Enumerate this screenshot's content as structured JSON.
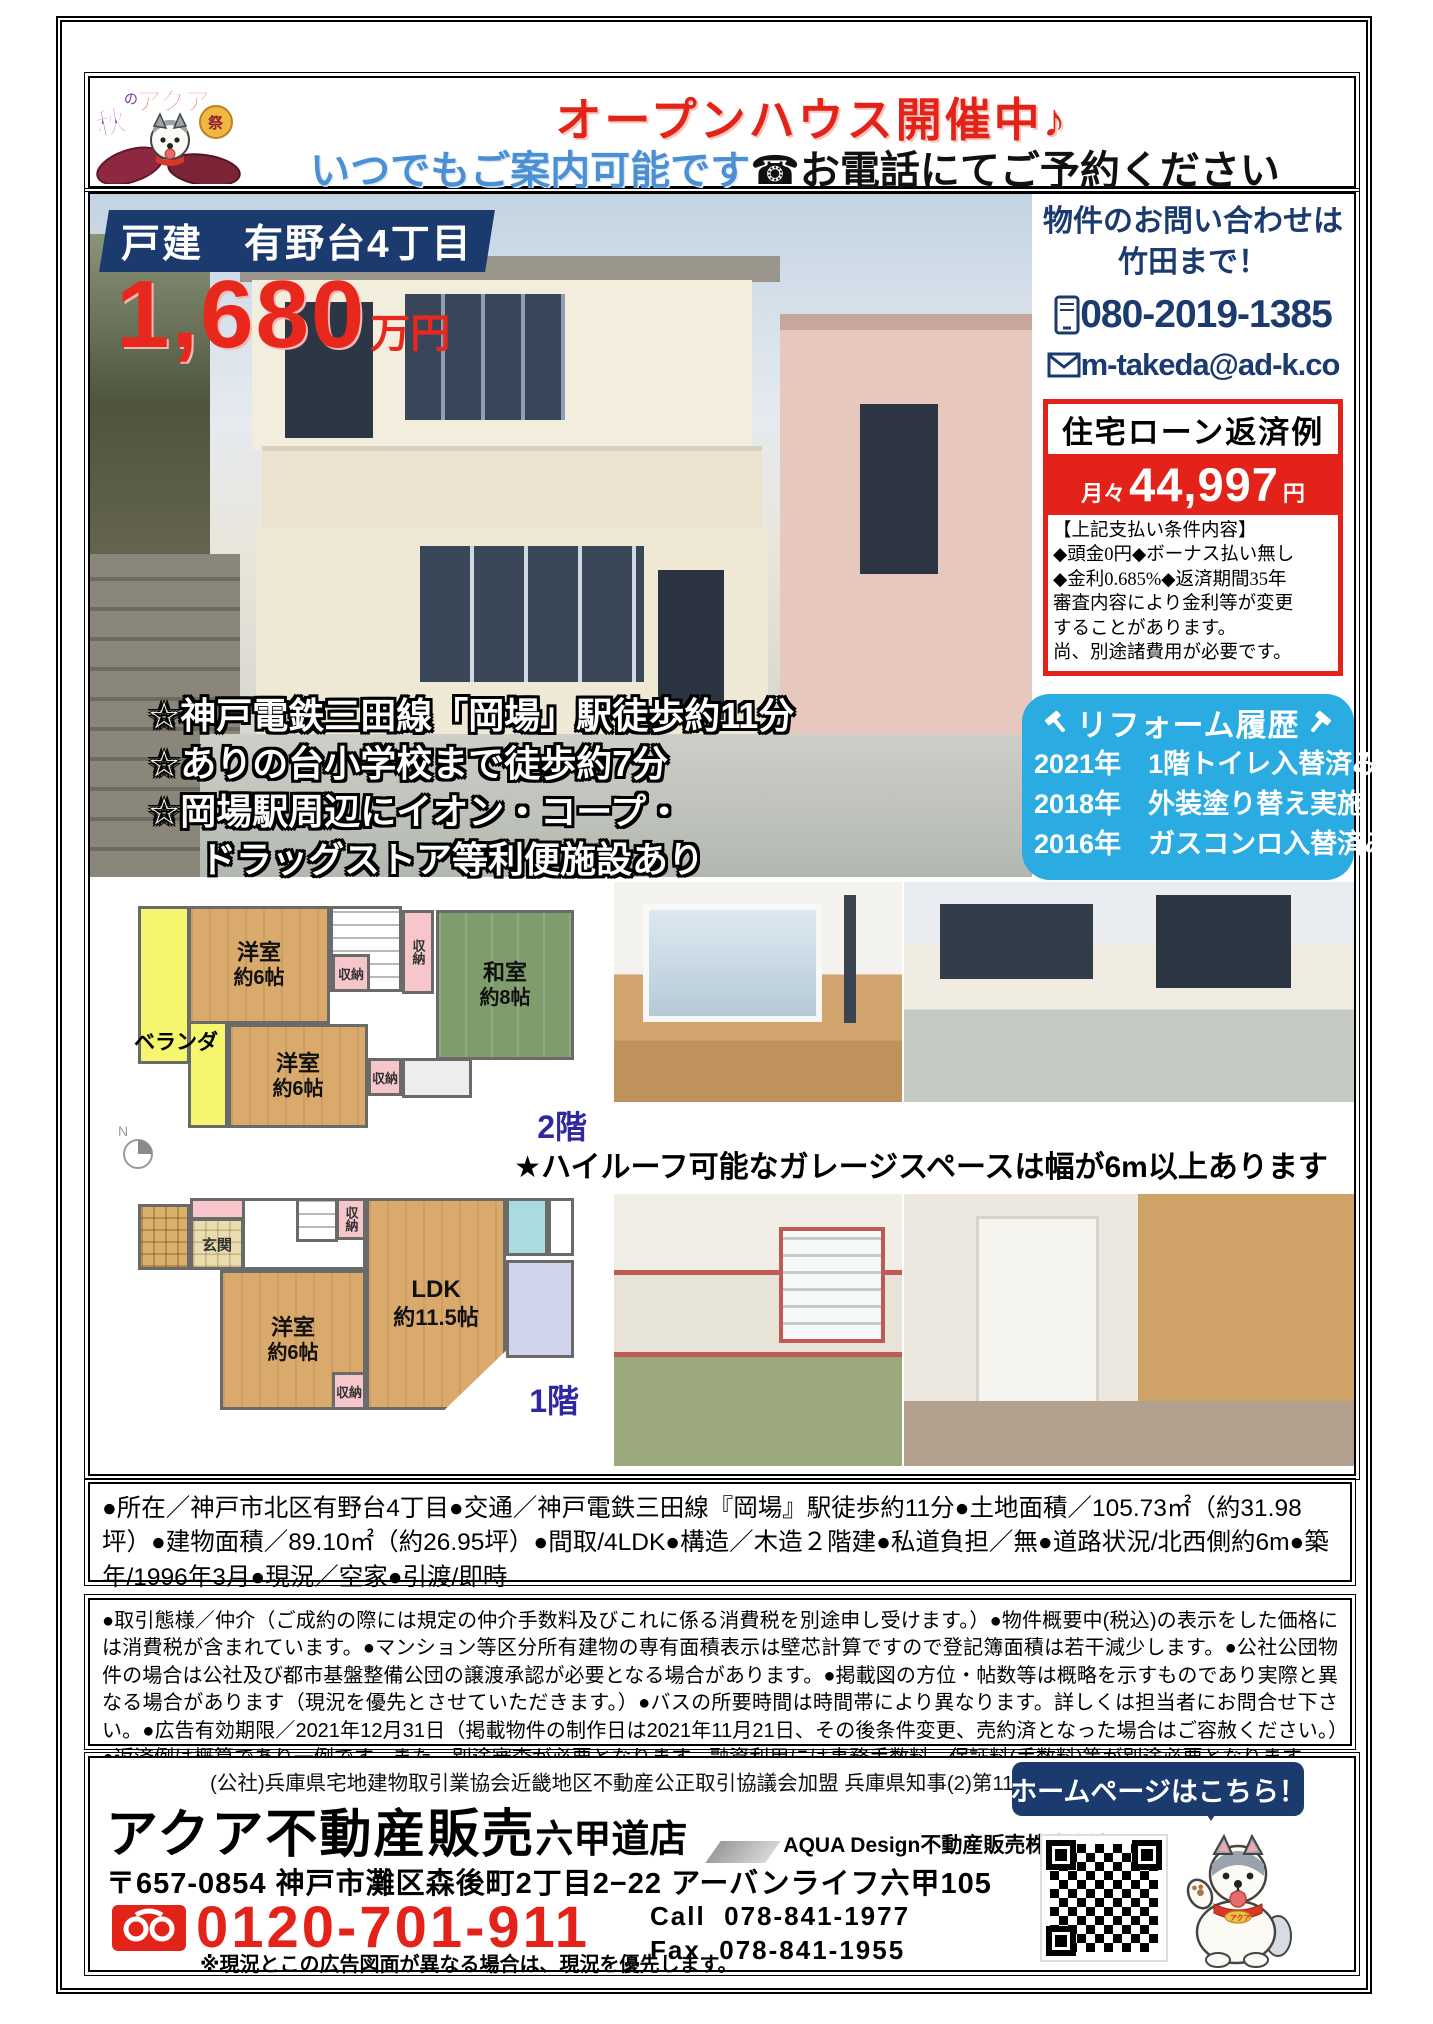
{
  "colors": {
    "navy": "#1b3a6e",
    "red": "#e3231a",
    "reform_blue": "#2aabe2",
    "subtitle_blue": "#4b8fd5"
  },
  "header": {
    "logo": {
      "aki": "秋",
      "no": "の",
      "aqua": "アクア",
      "fes": "祭"
    },
    "title": "オープンハウス開催中♪",
    "subtitle_blue": "いつでもご案内可能です",
    "subtitle_black": "☎お電話にてご予約ください"
  },
  "property": {
    "badge": "戸建　有野台4丁目",
    "price": "1,680",
    "price_unit": "万円",
    "features": [
      "☆神戸電鉄三田線「岡場」駅徒歩約11分",
      "☆ありの台小学校まで徒歩約7分",
      "☆岡場駅周辺にイオン・コープ・",
      "ドラッグストア等利便施設あり"
    ]
  },
  "contact": {
    "line1": "物件のお問い合わせは",
    "line2": "竹田まで！",
    "phone": "080-2019-1385",
    "email": "m-takeda@ad-k.co"
  },
  "loan": {
    "title": "住宅ローン返済例",
    "monthly_prefix": "月々",
    "monthly_amount": "44,997",
    "monthly_unit": "円",
    "conditions": [
      "【上記支払い条件内容】",
      "◆頭金0円◆ボーナス払い無し",
      "◆金利0.685%◆返済期間35年",
      "審査内容により金利等が変更",
      "することがあります。",
      "尚、別途諸費用が必要です。"
    ]
  },
  "reform": {
    "title": "リフォーム履歴",
    "items": [
      "2021年　1階トイレ入替済み",
      "2018年　外装塗り替え実施",
      "2016年　ガスコンロ入替済み"
    ]
  },
  "garage_note": "★ハイルーフ可能なガレージスペースは幅が6m以上あります",
  "floorplan_2f": {
    "label": "2階",
    "room1_name": "洋室",
    "room1_size": "約6帖",
    "room2_name": "和室",
    "room2_size": "約8帖",
    "room3_name": "洋室",
    "room3_size": "約6帖",
    "veranda": "ベランダ",
    "closet": "収納",
    "compass": "N"
  },
  "floorplan_1f": {
    "label": "1階",
    "entrance": "玄関",
    "room_name": "洋室",
    "room_size": "約6帖",
    "ldk_name": "LDK",
    "ldk_size": "約11.5帖",
    "closet": "収納"
  },
  "details": "●所在／神戸市北区有野台4丁目●交通／神戸電鉄三田線『岡場』駅徒歩約11分●土地面積／105.73㎡（約31.98坪）●建物面積／89.10㎡（約26.95坪）●間取/4LDK●構造／木造２階建●私道負担／無●道路状況/北西側約6m●築年/1996年3月●現況／空家●引渡/即時",
  "disclaimer": "●取引態様／仲介（ご成約の際には規定の仲介手数料及びこれに係る消費税を別途申し受けます。）●物件概要中(税込)の表示をした価格には消費税が含まれています。●マンション等区分所有建物の専有面積表示は壁芯計算ですので登記簿面積は若干減少します。●公社公団物件の場合は公社及び都市基盤整備公団の譲渡承認が必要となる場合があります。●掲載図の方位・帖数等は概略を示すものであり実際と異なる場合があります（現況を優先とさせていただきます。）●バスの所要時間は時間帯により異なります。詳しくは担当者にお問合せ下さい。●広告有効期限／2021年12月31日（掲載物件の制作日は2021年11月21日、その後条件変更、売約済となった場合はご容赦ください。）●返済例は概算であり一例です。また、別途審査が必要となります。融資利用には事務手数料、保証料(手数料)等が別途必要となります。",
  "footer": {
    "license": "(公社)兵庫県宅地建物取引業協会近畿地区不動産公正取引協議会加盟 兵庫県知事(2)第11495号",
    "company": "アクア不動産販売",
    "branch": "六甲道店",
    "company_sub": "AQUA Design不動産販売株式会社",
    "address": "〒657-0854 神戸市灘区森後町2丁目2−22 アーバンライフ六甲105",
    "tollfree": "0120-701-911",
    "call_label": "Call",
    "call": "078-841-1977",
    "fax_label": "Fax",
    "fax": "078-841-1955",
    "note": "※現況とこの広告図面が異なる場合は、現況を優先します。",
    "homepage": "ホームページはこちら！"
  }
}
